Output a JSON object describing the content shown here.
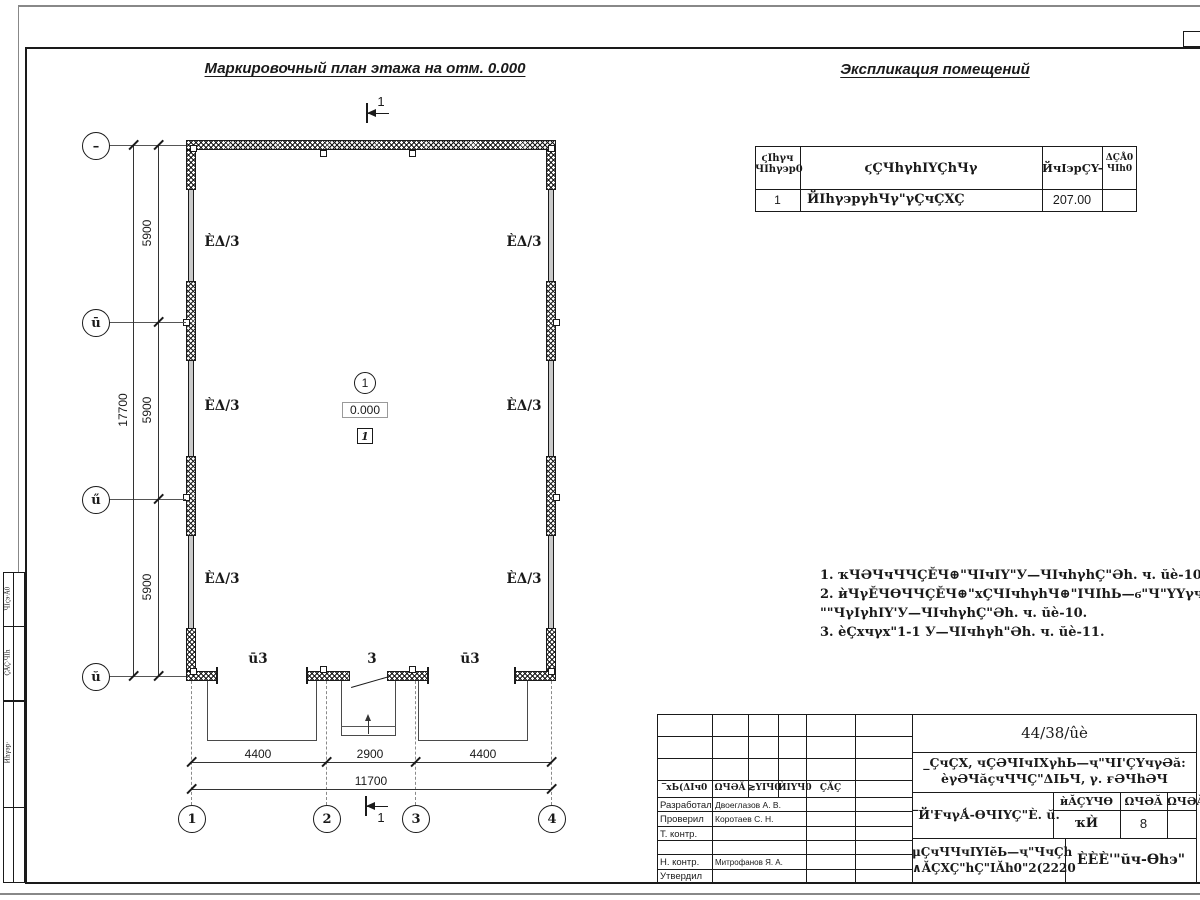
{
  "titles": {
    "plan": "Маркировочный план этажа на отм. 0.000",
    "explication": "Экспликация помещений"
  },
  "explication": {
    "header": {
      "c1_l1": "ϛIhγч",
      "c1_l2": "ЧIhγ϶р0",
      "c2": "ϛÇЧhγhIYÇhЧγ",
      "c3": "ЙчI϶рÇY-",
      "c4_l1": "ΔÇÅ0",
      "c4_l2": "ЧIh0"
    },
    "row": {
      "num": "1",
      "name": "ЙIhγ϶рγhЧγ\"γÇчÇXÇ",
      "area": "207.00",
      "note": ""
    }
  },
  "plan": {
    "dims_left": [
      "5900",
      "5900",
      "5900"
    ],
    "dim_left_total": "17700",
    "dims_bottom": [
      "4400",
      "2900",
      "4400"
    ],
    "dim_bottom_total": "11700",
    "axes_left": [
      "–",
      "ū",
      "ű",
      "ŭ"
    ],
    "axes_bottom": [
      "1",
      "2",
      "3",
      "4"
    ],
    "room_type_label": "ÈΔ/3",
    "opening_labels": [
      "ū3",
      "3",
      "ū3"
    ],
    "room_number": "1",
    "elevation": "0.000",
    "floor_type_mark": "1",
    "section_mark": "1"
  },
  "notes": [
    "1. ҡЧӘЧчЧЧÇĔЧ⊕\"ЧIчIY\"У—ЧIчhγhÇ\"Әh. ч. ŭè-10.",
    "2. ѝЧγĔЧѲЧЧÇĔЧ⊕\"хÇЧIчhγhЧ⊕\"IЧIhЬ—ϭ\"Ч\"YYγчЬ—ϭ",
    "\"\"ЧγIγhIY'У—ЧIчhγhÇ\"Әh. ч. ŭè-10.",
    "3. ѐÇхчγх\"1-1 У—ЧIчhγh\"Әh. ч. ŭè-11."
  ],
  "title_block": {
    "doc_number": "44/38/ûè",
    "project_line1": "_ÇчÇX, чÇӘЧIчIXγhЬ—ҷ\"ЧI'ÇYчγӘă:",
    "project_line2": "ѐγӘЧăçчЧЧÇ\"ΔIЬЧ, γ. ғӘЧhӘЧ",
    "drawing_title": "‾Й'ҒчγǺ-ѲЧIYÇ\"È. ŭ.",
    "doc_type_line1": "μÇчЧЧчIYIĕЬ—ҷ\"ЧчÇh",
    "doc_type_line2": "∧ĂÇXÇ\"hÇ\"IĂh0\"2(2220",
    "organization": "ÈÈÈ'\"ŭч-Ѳh϶\"",
    "stage_headers": [
      "ѝĂÇYЧѲ",
      "ΩЧӘĂ",
      "ΩЧӘĂIY"
    ],
    "stage_values": [
      "ҡЍ",
      "8",
      ""
    ],
    "sign_headers": [
      "‾хЬ(ΔIч0",
      "ΩЧӘĂ",
      "≳YIЧ0",
      "ЍIYЧ0",
      "ÇĂÇ",
      ""
    ],
    "roles": [
      {
        "role": "Разработал",
        "name": "Двоеглазов А. В."
      },
      {
        "role": "Проверил",
        "name": "Коротаев С. Н."
      },
      {
        "role": "Т. контр.",
        "name": ""
      },
      {
        "role": "",
        "name": ""
      },
      {
        "role": "Н. контр.",
        "name": "Митрофанов Я. А."
      },
      {
        "role": "Утвердил",
        "name": ""
      }
    ]
  },
  "left_stamp": [
    "ЧIϛ϶·Å0",
    "ÇĂÇ·ЧIh",
    "Ѝhγ϶р·"
  ]
}
